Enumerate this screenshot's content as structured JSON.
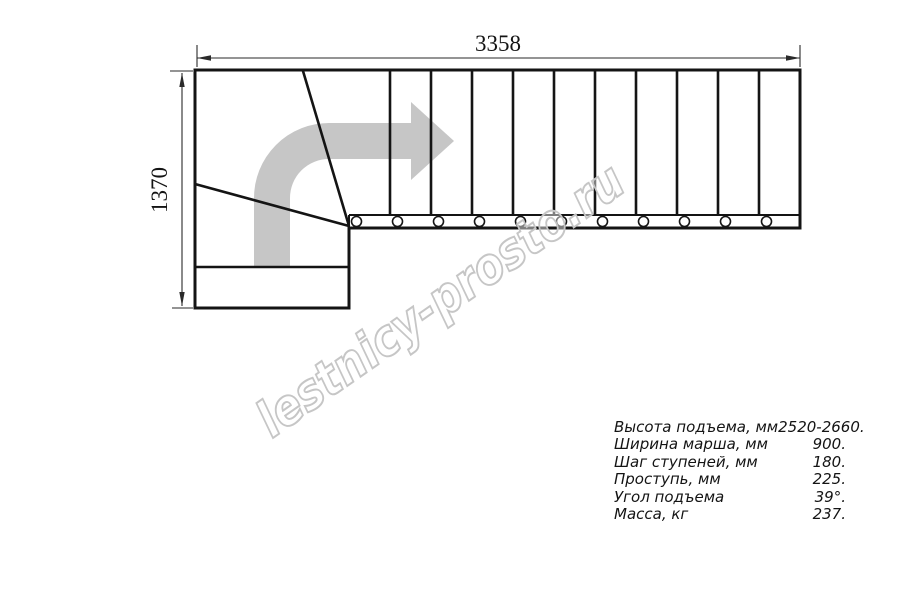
{
  "drawing": {
    "description": "L-shaped staircase plan, top view, turn to the right",
    "straight_steps": 11,
    "winder_steps": 3,
    "entry_steps": 2
  },
  "dimensions": {
    "width_label": "3358",
    "depth_label": "1370"
  },
  "watermark": {
    "text": "lestnicy-prosto.ru"
  },
  "specs": {
    "rows": [
      {
        "label": "Высота подъема, мм",
        "value": "2520-2660."
      },
      {
        "label": "Ширина марша, мм",
        "value": "900."
      },
      {
        "label": "Шаг ступеней, мм",
        "value": "180."
      },
      {
        "label": "Проступь, мм",
        "value": "225."
      },
      {
        "label": "Угол подъема",
        "value": "39°."
      },
      {
        "label": "Масса, кг",
        "value": "237."
      }
    ]
  },
  "colors": {
    "line": "#141414",
    "arrow": "#c6c6c6",
    "watermark": "#c6c6c6"
  }
}
